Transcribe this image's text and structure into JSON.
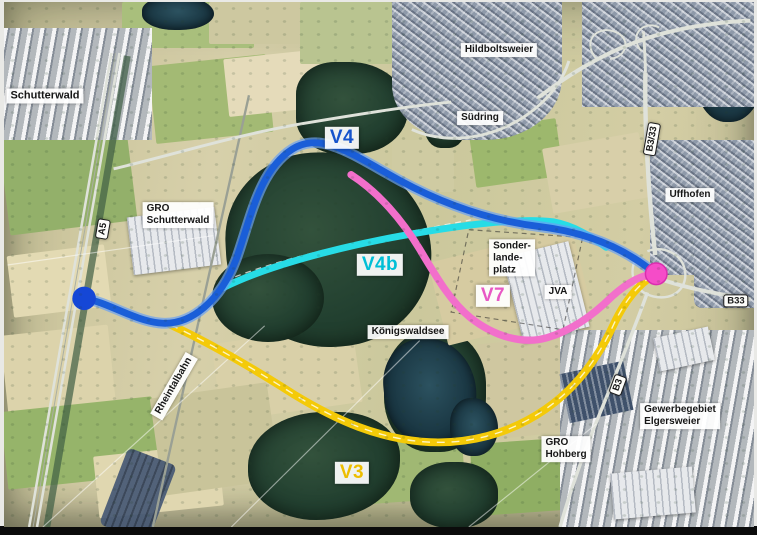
{
  "map": {
    "description": "Aerial photograph plan of route variants between Schutterwald and Elgersweier",
    "route_lines": [
      {
        "id": "V4",
        "name": "V4",
        "color": "#1a5ed8",
        "halo": "#6aa0f2",
        "label": {
          "text": "V4",
          "x": 338,
          "y": 136,
          "color": "#1553cc"
        }
      },
      {
        "id": "V4b",
        "name": "V4b",
        "color": "#27dce6",
        "label": {
          "text": "V4b",
          "x": 376,
          "y": 263,
          "color": "#00bfd6"
        }
      },
      {
        "id": "V7",
        "name": "V7",
        "color": "#f26fcb",
        "label": {
          "text": "V7",
          "x": 489,
          "y": 294,
          "color": "#e858c4"
        }
      },
      {
        "id": "V3",
        "name": "V3",
        "color": "#f4ca08",
        "label": {
          "text": "V3",
          "x": 348,
          "y": 471,
          "color": "#edbe00"
        }
      }
    ],
    "endpoints": [
      {
        "id": "west-terminus",
        "color": "#1547d6",
        "x": 78,
        "y": 302,
        "r": 12
      },
      {
        "id": "east-terminus",
        "color": "#f54cc8",
        "x": 661,
        "y": 277,
        "r": 11
      }
    ],
    "place_labels": [
      {
        "id": "schutterwald",
        "text": "Schutterwald",
        "x": 41,
        "y": 94,
        "size": 11
      },
      {
        "id": "hildboltsweier",
        "text": "Hildboltsweier",
        "x": 495,
        "y": 48
      },
      {
        "id": "suedring",
        "text": "Südring",
        "x": 476,
        "y": 116
      },
      {
        "id": "uffhofen",
        "text": "Uffhofen",
        "x": 686,
        "y": 193
      },
      {
        "id": "gro-schutterwald",
        "text": "GRO\nSchutterwald",
        "x": 174,
        "y": 213,
        "align": "left"
      },
      {
        "id": "sonderlandeplatz",
        "text": "Sonder-\nlande-\nplatz",
        "x": 508,
        "y": 256,
        "align": "left"
      },
      {
        "id": "jva",
        "text": "JVA",
        "x": 554,
        "y": 290
      },
      {
        "id": "koenigswaldsee",
        "text": "Königswaldsee",
        "x": 404,
        "y": 330
      },
      {
        "id": "gro-hohberg",
        "text": "GRO\nHohberg",
        "x": 562,
        "y": 447,
        "align": "left"
      },
      {
        "id": "gewerbegebiet-elgersweier",
        "text": "Gewerbegebiet\nElgersweier",
        "x": 676,
        "y": 414,
        "align": "left"
      },
      {
        "id": "rheintalbahn",
        "text": "Rheintalbahn",
        "x": 170,
        "y": 384,
        "rot": -60
      }
    ],
    "road_signs": [
      {
        "id": "a5",
        "text": "A5",
        "x": 99,
        "y": 227,
        "rot": -80
      },
      {
        "id": "b3-33",
        "text": "B3/33",
        "x": 648,
        "y": 137,
        "rot": -80
      },
      {
        "id": "b33",
        "text": "B33",
        "x": 732,
        "y": 299,
        "rot": 0
      },
      {
        "id": "b3",
        "text": "B3",
        "x": 614,
        "y": 383,
        "rot": -70
      }
    ]
  }
}
